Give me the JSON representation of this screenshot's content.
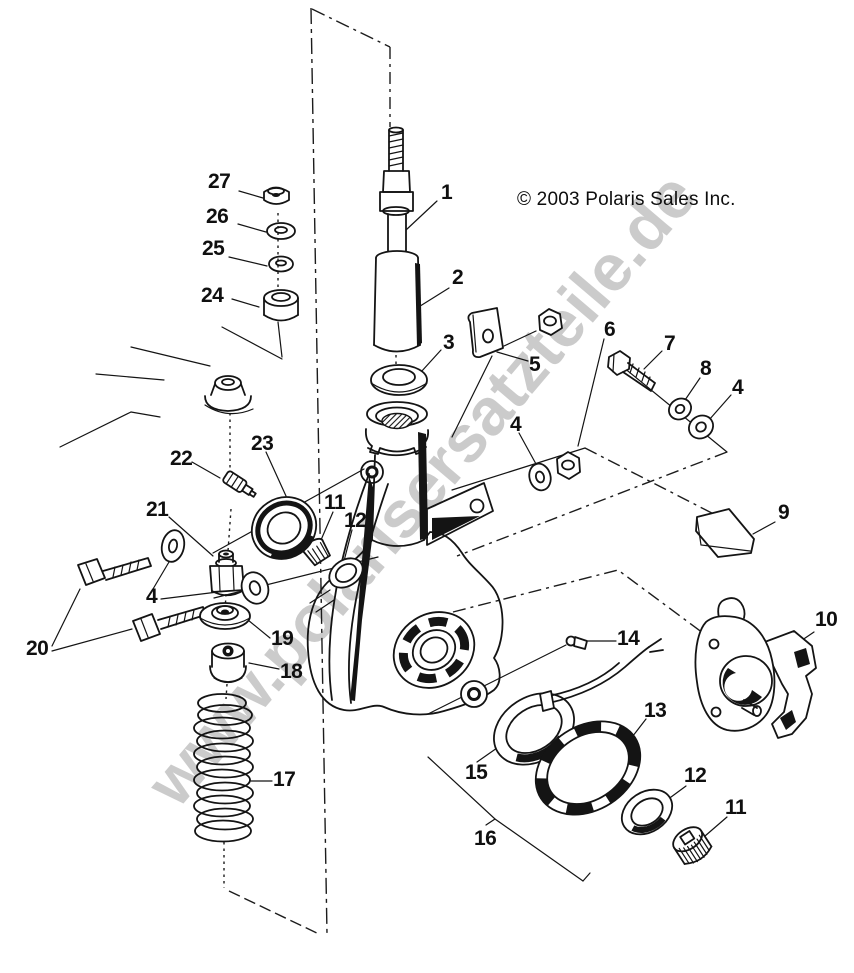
{
  "page": {
    "background": "#ffffff",
    "line_color": "#141414",
    "watermark_color": "#cbcbcb"
  },
  "copyright_notice": "© 2003 Polaris Sales Inc.",
  "watermark_text": "www.polarisersatzteile.de",
  "diagram": {
    "type": "exploded-parts-diagram",
    "subject": "Front strut and steering knuckle assembly",
    "callouts": [
      {
        "id": "callout-1",
        "label": "1"
      },
      {
        "id": "callout-2",
        "label": "2"
      },
      {
        "id": "callout-3",
        "label": "3"
      },
      {
        "id": "callout-4-right",
        "label": "4"
      },
      {
        "id": "callout-4-mid",
        "label": "4"
      },
      {
        "id": "callout-4-left",
        "label": "4"
      },
      {
        "id": "callout-5",
        "label": "5"
      },
      {
        "id": "callout-6",
        "label": "6"
      },
      {
        "id": "callout-7",
        "label": "7"
      },
      {
        "id": "callout-8",
        "label": "8"
      },
      {
        "id": "callout-9",
        "label": "9"
      },
      {
        "id": "callout-10",
        "label": "10"
      },
      {
        "id": "callout-11-upper",
        "label": "11"
      },
      {
        "id": "callout-11-lower",
        "label": "11"
      },
      {
        "id": "callout-12-upper",
        "label": "12"
      },
      {
        "id": "callout-12-lower",
        "label": "12"
      },
      {
        "id": "callout-13",
        "label": "13"
      },
      {
        "id": "callout-14",
        "label": "14"
      },
      {
        "id": "callout-15",
        "label": "15"
      },
      {
        "id": "callout-16",
        "label": "16"
      },
      {
        "id": "callout-17",
        "label": "17"
      },
      {
        "id": "callout-18",
        "label": "18"
      },
      {
        "id": "callout-19",
        "label": "19"
      },
      {
        "id": "callout-20",
        "label": "20"
      },
      {
        "id": "callout-21",
        "label": "21"
      },
      {
        "id": "callout-22",
        "label": "22"
      },
      {
        "id": "callout-23",
        "label": "23"
      },
      {
        "id": "callout-24",
        "label": "24"
      },
      {
        "id": "callout-25",
        "label": "25"
      },
      {
        "id": "callout-26",
        "label": "26"
      },
      {
        "id": "callout-27",
        "label": "27"
      }
    ]
  }
}
